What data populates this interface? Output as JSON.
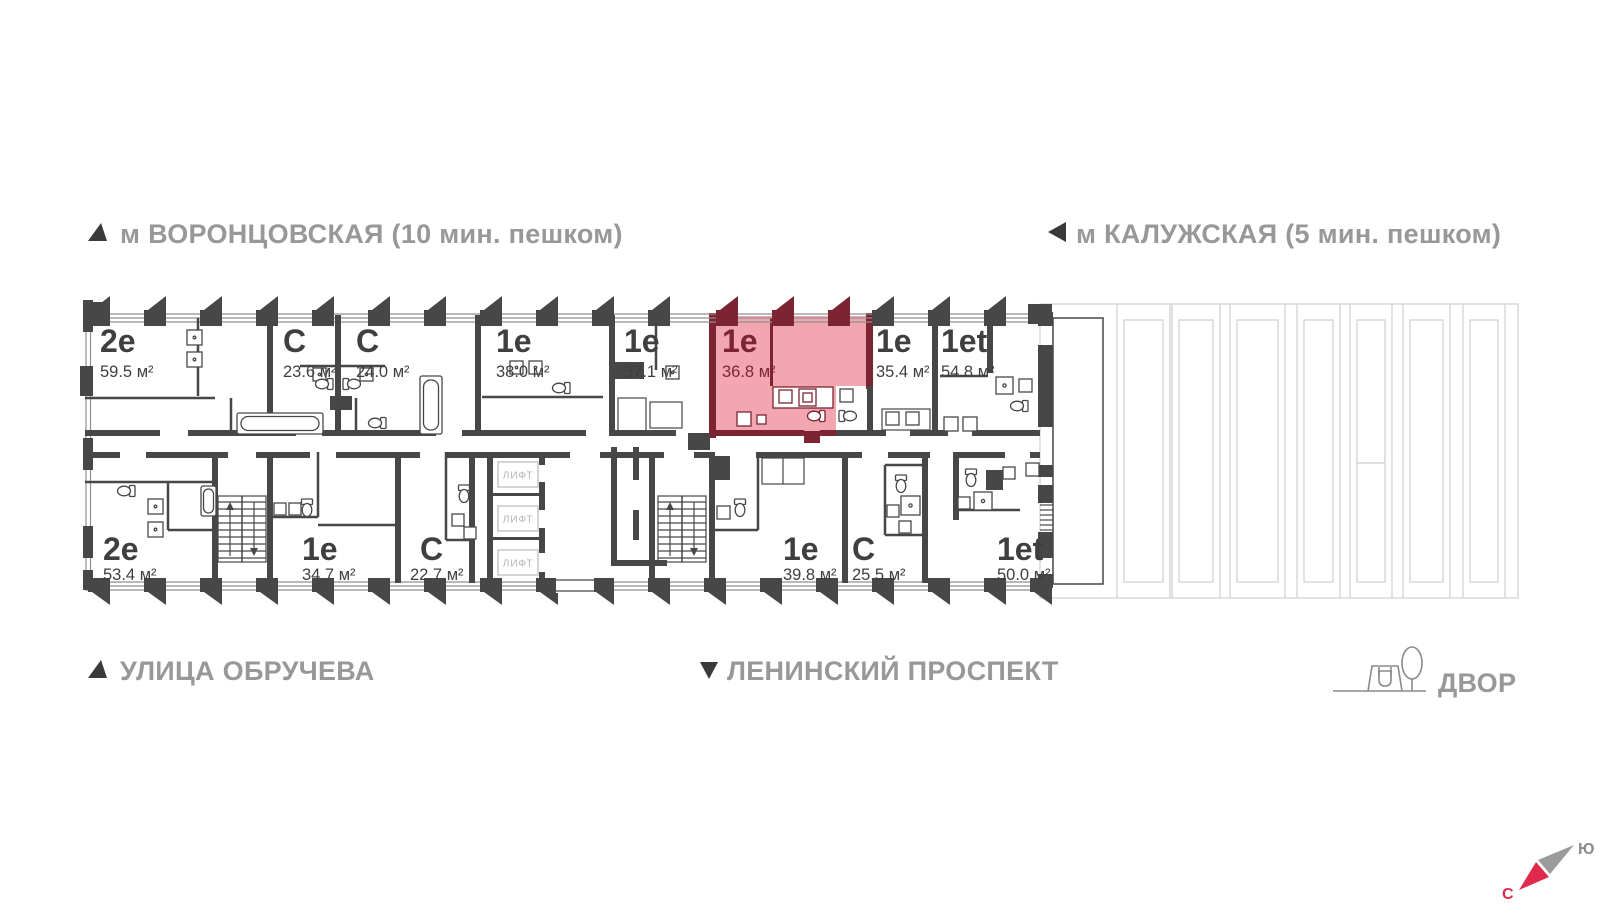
{
  "map_labels": {
    "metro_left": "м ВОРОНЦОВСКАЯ  (10 мин. пешком)",
    "metro_right": "м КАЛУЖСКАЯ (5 мин. пешком)",
    "street_bottom_left": "УЛИЦА ОБРУЧЕВА",
    "street_bottom_center": "ЛЕНИНСКИЙ ПРОСПЕКТ",
    "yard": "ДВОР"
  },
  "compass": {
    "north": "С",
    "south": "Ю"
  },
  "labels": {
    "elevator": "ЛИФТ"
  },
  "apartments": {
    "top": [
      {
        "type": "2е",
        "area": "59.5 м²"
      },
      {
        "type": "С",
        "area": "23.6 м²"
      },
      {
        "type": "С",
        "area": "24.0 м²"
      },
      {
        "type": "1е",
        "area": "38.0 м²"
      },
      {
        "type": "1е",
        "area": "37.1 м²"
      },
      {
        "type": "1е",
        "area": "36.8 м²",
        "highlighted": true
      },
      {
        "type": "1е",
        "area": "35.4 м²"
      },
      {
        "type": "1et",
        "area": "54.8 м²"
      }
    ],
    "bottom": [
      {
        "type": "2е",
        "area": "53.4 м²"
      },
      {
        "type": "1е",
        "area": "34.7 м²"
      },
      {
        "type": "С",
        "area": "22.7 м²"
      },
      {
        "type": "1е",
        "area": "39.8 м²"
      },
      {
        "type": "С",
        "area": "25.5 м²"
      },
      {
        "type": "1et",
        "area": "50.0 м²"
      }
    ]
  },
  "colors": {
    "wall": "#474747",
    "highlight_fill": "#f1a6b0",
    "highlight_wall": "#7c2431",
    "ghost": "#d5d5d5",
    "label_gray": "#98989a",
    "compass_red": "#e02a4c"
  }
}
